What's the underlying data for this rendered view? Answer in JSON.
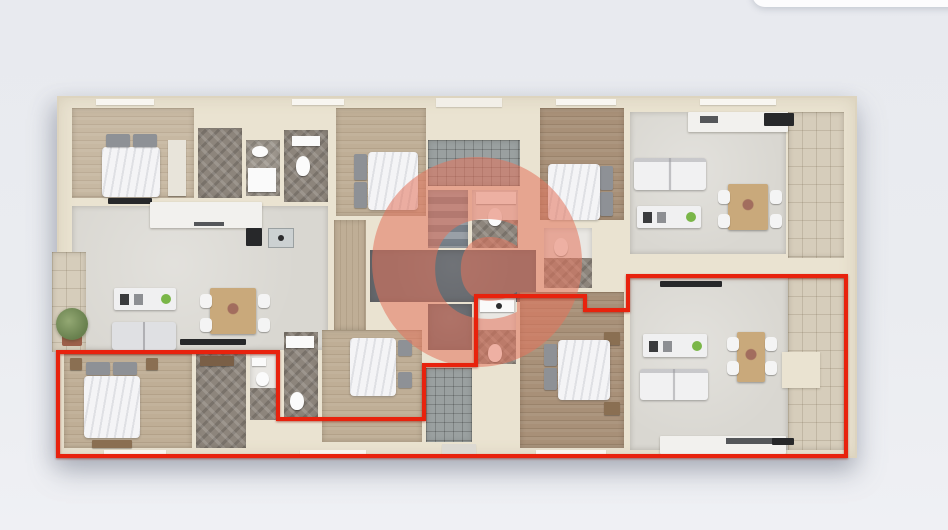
{
  "scene": {
    "kind": "apartment-building-floor-plan-3d-render",
    "view": "top-down"
  },
  "colors": {
    "background": "#e8eaef",
    "panel_white": "#fcfcfd",
    "accent_red": "#e8220d",
    "watermark_salmon": "#e4745c",
    "wall_cream": "#eae3d1",
    "wood_light": "#c7b8a2",
    "wood_mid": "#bfae96",
    "wood_dark": "#a89078",
    "herringbone": "#8d857c",
    "living_floor": "#d9d7d1",
    "stone_tile": "#d6cdbb",
    "entry_tile": "#9aa0a0",
    "core_dark": "#64676c",
    "furniture_wood": "#c9a97b"
  },
  "watermark": {
    "letter": "C",
    "cx": 477,
    "cy": 262,
    "r": 105,
    "opacity": 0.55,
    "glyph_cx": 477,
    "glyph_cy": 272,
    "glyph_size": 132
  },
  "highlight_outline": {
    "color": "#e8220d",
    "stroke_width": 4,
    "points": "58,352 278,352 278,419 424,419 424,365 476,365 476,296 585,296 585,310 628,310 628,276 846,276 846,456 58,456"
  }
}
